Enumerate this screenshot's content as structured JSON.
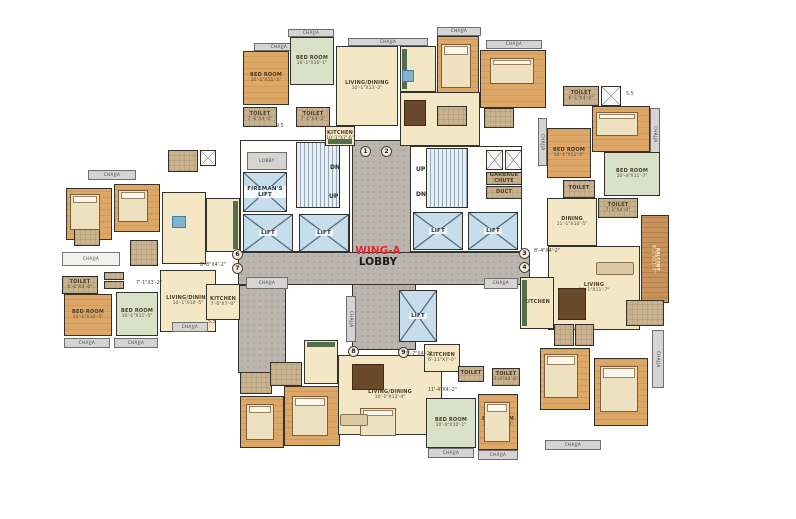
{
  "meta": {
    "width": 796,
    "height": 519,
    "background": "#ffffff",
    "description_labels": {
      "lift": "LIFT",
      "chajja": "CHAJJA"
    }
  },
  "title": {
    "wing": "WING-A",
    "lobby": "LOBBY",
    "wing_color": "#e8262d",
    "lobby_color": "#1a1a1a"
  },
  "palette": {
    "wall": "#33312c",
    "wood_floor": "#d4a05c",
    "green_floor": "#d9e2c8",
    "cream_floor": "#f3e7c6",
    "toilet_floor": "#c9b28d",
    "lift": "#c6ddec",
    "corridor": "#bab6ad",
    "balcony": "#c8935b",
    "accent_red": "#e8262d"
  },
  "rooms": [
    {
      "name": "lobby-corridor-vertical",
      "f": "corridor",
      "x": 352,
      "y": 140,
      "w": 64,
      "h": 210
    },
    {
      "name": "lobby-corridor-horizontal",
      "f": "corridor",
      "x": 238,
      "y": 252,
      "w": 292,
      "h": 33
    },
    {
      "name": "lobby-corridor-branch",
      "f": "corridor",
      "x": 238,
      "y": 285,
      "w": 48,
      "h": 88
    },
    {
      "name": "stair-hall-left",
      "f": "white",
      "x": 240,
      "y": 140,
      "w": 110,
      "h": 112
    },
    {
      "name": "stair-hall-right",
      "f": "white",
      "x": 410,
      "y": 146,
      "w": 112,
      "h": 106
    },
    {
      "name": "lobby-box",
      "f": "gray",
      "label": "LOBBY",
      "x": 247,
      "y": 152,
      "w": 40,
      "h": 18
    },
    {
      "name": "firemans-lift",
      "f": "lift",
      "label": "FIREMAN'S LIFT",
      "x": 243,
      "y": 172,
      "w": 44,
      "h": 40
    },
    {
      "name": "staircase-left",
      "f": "stairs",
      "x": 296,
      "y": 142,
      "w": 44,
      "h": 66
    },
    {
      "name": "lift-1",
      "f": "lift",
      "label": "LIFT",
      "x": 243,
      "y": 214,
      "w": 50,
      "h": 38
    },
    {
      "name": "lift-2",
      "f": "lift",
      "label": "LIFT",
      "x": 299,
      "y": 214,
      "w": 50,
      "h": 38
    },
    {
      "name": "staircase-right",
      "f": "stairs",
      "x": 426,
      "y": 148,
      "w": 42,
      "h": 60
    },
    {
      "name": "duct-box",
      "f": "xbox",
      "x": 486,
      "y": 150,
      "w": 17,
      "h": 20
    },
    {
      "name": "duct-box",
      "f": "xbox",
      "x": 505,
      "y": 150,
      "w": 17,
      "h": 20
    },
    {
      "name": "garbage-chute",
      "f": "tan",
      "label": "GARBAGE CHUTE",
      "x": 486,
      "y": 172,
      "w": 36,
      "h": 13
    },
    {
      "name": "duct",
      "f": "tan",
      "label": "DUCT",
      "x": 486,
      "y": 186,
      "w": 36,
      "h": 13
    },
    {
      "name": "lift-3",
      "f": "lift",
      "label": "LIFT",
      "x": 413,
      "y": 212,
      "w": 50,
      "h": 38
    },
    {
      "name": "lift-4",
      "f": "lift",
      "label": "LIFT",
      "x": 468,
      "y": 212,
      "w": 50,
      "h": 38
    },
    {
      "name": "lift-5",
      "f": "lift",
      "label": "LIFT",
      "x": 399,
      "y": 290,
      "w": 38,
      "h": 52
    },
    {
      "name": "chajja",
      "f": "gray",
      "label": "CHAJJA",
      "v": 1,
      "x": 346,
      "y": 296,
      "w": 10,
      "h": 46
    },
    {
      "name": "chajja",
      "f": "gray",
      "label": "CHAJJA",
      "x": 288,
      "y": 29,
      "w": 46,
      "h": 8
    },
    {
      "name": "chajja",
      "f": "gray",
      "label": "CHAJJA",
      "x": 254,
      "y": 43,
      "w": 50,
      "h": 8
    },
    {
      "name": "chajja",
      "f": "gray",
      "label": "CHAJJA",
      "x": 348,
      "y": 38,
      "w": 80,
      "h": 8
    },
    {
      "name": "bedroom",
      "f": "wood",
      "label": "BED ROOM",
      "dims": "10'-1\"X11'-5\"",
      "x": 243,
      "y": 51,
      "w": 46,
      "h": 54
    },
    {
      "name": "bedroom",
      "f": "green",
      "label": "BED ROOM",
      "dims": "10'-1\"X10'-1\"",
      "x": 290,
      "y": 37,
      "w": 44,
      "h": 48
    },
    {
      "name": "living-dining",
      "f": "cream",
      "label": "LIVING/DINING",
      "dims": "10'-1\"X13'-2\"",
      "x": 336,
      "y": 46,
      "w": 62,
      "h": 80
    },
    {
      "name": "toilet",
      "f": "tan",
      "label": "TOILET",
      "dims": "7'-6\"X4'-0\"",
      "x": 243,
      "y": 107,
      "w": 34,
      "h": 20
    },
    {
      "name": "toilet",
      "f": "tan",
      "label": "TOILET",
      "dims": "7'-1\"X4'-2\"",
      "x": 296,
      "y": 107,
      "w": 34,
      "h": 20
    },
    {
      "name": "kitchen",
      "f": "cream",
      "label": "KITCHEN",
      "dims": "10'-1\"X7'-6\"",
      "x": 325,
      "y": 126,
      "w": 30,
      "h": 20,
      "deco": "cb"
    },
    {
      "name": "duct-box",
      "f": "xbox",
      "x": 200,
      "y": 150,
      "w": 16,
      "h": 16
    },
    {
      "name": "entrance-lobby",
      "f": "tan",
      "x": 168,
      "y": 150,
      "w": 30,
      "h": 22
    },
    {
      "name": "chajja",
      "f": "gray",
      "label": "CHAJJA",
      "x": 437,
      "y": 27,
      "w": 44,
      "h": 9
    },
    {
      "name": "chajja",
      "f": "gray",
      "label": "CHAJJA",
      "x": 486,
      "y": 40,
      "w": 56,
      "h": 9
    },
    {
      "name": "kitchen",
      "f": "cream",
      "x": 400,
      "y": 46,
      "w": 36,
      "h": 46,
      "deco": "cl"
    },
    {
      "name": "bedroom",
      "f": "wood",
      "x": 437,
      "y": 36,
      "w": 42,
      "h": 70
    },
    {
      "name": "bedroom",
      "f": "wood",
      "x": 480,
      "y": 50,
      "w": 66,
      "h": 58
    },
    {
      "name": "living-dining",
      "f": "cream",
      "x": 400,
      "y": 92,
      "w": 80,
      "h": 54
    },
    {
      "name": "toilet",
      "f": "tan",
      "x": 437,
      "y": 106,
      "w": 30,
      "h": 20
    },
    {
      "name": "toilet",
      "f": "tan",
      "x": 484,
      "y": 108,
      "w": 30,
      "h": 20
    },
    {
      "name": "toilet",
      "f": "tan",
      "label": "TOILET",
      "dims": "6'-1\"X4'-0\"",
      "x": 563,
      "y": 86,
      "w": 36,
      "h": 20
    },
    {
      "name": "duct-box",
      "f": "xbox",
      "x": 601,
      "y": 86,
      "w": 20,
      "h": 20
    },
    {
      "name": "bedroom",
      "f": "wood",
      "label": "BED ROOM",
      "dims": "10'-0\"X11'-1\"",
      "x": 592,
      "y": 106,
      "w": 58,
      "h": 46
    },
    {
      "name": "chajja",
      "f": "gray",
      "label": "CHAJJA",
      "v": 1,
      "x": 650,
      "y": 108,
      "w": 10,
      "h": 52
    },
    {
      "name": "chajja",
      "f": "gray",
      "label": "CHAJJA",
      "v": 1,
      "x": 538,
      "y": 118,
      "w": 9,
      "h": 48
    },
    {
      "name": "bedroom",
      "f": "wood",
      "label": "BED ROOM",
      "dims": "10'-1\"X11'-5\"",
      "x": 547,
      "y": 128,
      "w": 44,
      "h": 50
    },
    {
      "name": "bedroom",
      "f": "green",
      "label": "BED ROOM",
      "dims": "10'-4\"X11'-7\"",
      "x": 604,
      "y": 152,
      "w": 56,
      "h": 44
    },
    {
      "name": "toilet",
      "f": "tan",
      "label": "TOILET",
      "x": 563,
      "y": 180,
      "w": 32,
      "h": 18
    },
    {
      "name": "toilet",
      "f": "tan",
      "label": "TOILET",
      "dims": "7'-1\"X4'-0\"",
      "x": 598,
      "y": 198,
      "w": 40,
      "h": 20
    },
    {
      "name": "dining",
      "f": "cream",
      "label": "DINING",
      "dims": "11'-1\"X10'-5\"",
      "x": 547,
      "y": 198,
      "w": 50,
      "h": 48
    },
    {
      "name": "living",
      "f": "cream",
      "label": "LIVING",
      "dims": "10'-1\"X11'-7\"",
      "x": 548,
      "y": 246,
      "w": 92,
      "h": 84
    },
    {
      "name": "kitchen",
      "f": "cream",
      "label": "KITCHEN",
      "x": 520,
      "y": 277,
      "w": 34,
      "h": 52,
      "deco": "cl"
    },
    {
      "name": "balcony",
      "f": "balcony",
      "label": "BALCONY",
      "dims": "8'-1\"X11'-7\"",
      "v": 1,
      "x": 641,
      "y": 215,
      "w": 28,
      "h": 88
    },
    {
      "name": "toilet",
      "f": "tan",
      "x": 554,
      "y": 324,
      "w": 20,
      "h": 22
    },
    {
      "name": "toilet",
      "f": "tan",
      "x": 575,
      "y": 324,
      "w": 19,
      "h": 22
    },
    {
      "name": "bedroom",
      "f": "wood",
      "x": 540,
      "y": 348,
      "w": 50,
      "h": 62
    },
    {
      "name": "bedroom",
      "f": "wood",
      "x": 594,
      "y": 358,
      "w": 54,
      "h": 68
    },
    {
      "name": "dress",
      "f": "tan",
      "x": 626,
      "y": 300,
      "w": 38,
      "h": 26
    },
    {
      "name": "chajja",
      "f": "gray",
      "label": "CHAJJA",
      "v": 1,
      "x": 652,
      "y": 330,
      "w": 12,
      "h": 58
    },
    {
      "name": "chajja",
      "f": "gray",
      "label": "CHAJJA",
      "x": 545,
      "y": 440,
      "w": 56,
      "h": 10
    },
    {
      "name": "toilet",
      "f": "tan",
      "x": 240,
      "y": 372,
      "w": 32,
      "h": 22
    },
    {
      "name": "bedroom",
      "f": "wood",
      "x": 240,
      "y": 396,
      "w": 44,
      "h": 52
    },
    {
      "name": "kitchen",
      "f": "cream",
      "x": 304,
      "y": 340,
      "w": 34,
      "h": 44,
      "deco": "ct"
    },
    {
      "name": "bath",
      "f": "tan",
      "x": 270,
      "y": 362,
      "w": 32,
      "h": 24
    },
    {
      "name": "bedroom",
      "f": "wood",
      "x": 284,
      "y": 386,
      "w": 56,
      "h": 60
    },
    {
      "name": "living-dining",
      "f": "cream",
      "label": "LIVING/DINING",
      "dims": "10'-1\"X13'-4\"",
      "x": 338,
      "y": 355,
      "w": 104,
      "h": 80
    },
    {
      "name": "kitchen",
      "f": "cream",
      "label": "KITCHEN",
      "dims": "6'-11\"X7'-0\"",
      "x": 424,
      "y": 344,
      "w": 36,
      "h": 28
    },
    {
      "name": "toilet",
      "f": "tan",
      "label": "TOILET",
      "x": 458,
      "y": 366,
      "w": 26,
      "h": 16
    },
    {
      "name": "toilet",
      "f": "tan",
      "label": "TOILET",
      "dims": "7'-0\"X4'-0\"",
      "x": 492,
      "y": 368,
      "w": 28,
      "h": 18
    },
    {
      "name": "bedroom",
      "f": "green",
      "label": "BED ROOM",
      "dims": "10'-4\"X10'-1\"",
      "x": 426,
      "y": 398,
      "w": 50,
      "h": 50
    },
    {
      "name": "bedroom",
      "f": "wood",
      "label": "BED ROOM",
      "dims": "10'-0\"X11'-0\"",
      "x": 478,
      "y": 394,
      "w": 40,
      "h": 56
    },
    {
      "name": "chajja",
      "f": "gray",
      "label": "CHAJJA",
      "x": 428,
      "y": 448,
      "w": 46,
      "h": 10
    },
    {
      "name": "chajja",
      "f": "gray",
      "label": "CHAJJA",
      "x": 478,
      "y": 450,
      "w": 40,
      "h": 10
    },
    {
      "name": "chajja",
      "f": "gray",
      "label": "CHAJJA",
      "x": 484,
      "y": 278,
      "w": 34,
      "h": 11
    },
    {
      "name": "toilet",
      "f": "tan",
      "label": "TOILET",
      "dims": "6'-0\"X4'-0\"",
      "x": 62,
      "y": 276,
      "w": 36,
      "h": 18
    },
    {
      "name": "wardrobe",
      "f": "tan",
      "x": 104,
      "y": 272,
      "w": 20,
      "h": 8
    },
    {
      "name": "wardrobe",
      "f": "tan",
      "x": 104,
      "y": 281,
      "w": 20,
      "h": 8
    },
    {
      "name": "bedroom",
      "f": "wood",
      "label": "BED ROOM",
      "dims": "10'-1\"X10'-5\"",
      "x": 64,
      "y": 294,
      "w": 48,
      "h": 42
    },
    {
      "name": "bedroom",
      "f": "green",
      "label": "BED ROOM",
      "dims": "10'-1\"X11'-5\"",
      "x": 116,
      "y": 292,
      "w": 42,
      "h": 44
    },
    {
      "name": "living-dining",
      "f": "cream",
      "label": "LIVING/DINING",
      "dims": "10'-1\"X10'-5\"",
      "x": 160,
      "y": 270,
      "w": 56,
      "h": 62
    },
    {
      "name": "kitchen",
      "f": "cream",
      "label": "KITCHEN",
      "dims": "7'-6\"X7'-0\"",
      "x": 206,
      "y": 284,
      "w": 34,
      "h": 36
    },
    {
      "name": "chajja",
      "f": "gray",
      "label": "CHAJJA",
      "x": 64,
      "y": 338,
      "w": 46,
      "h": 10
    },
    {
      "name": "chajja",
      "f": "gray",
      "label": "CHAJJA",
      "x": 114,
      "y": 338,
      "w": 44,
      "h": 10
    },
    {
      "name": "chajja",
      "f": "gray",
      "label": "CHAJJA",
      "x": 246,
      "y": 277,
      "w": 42,
      "h": 12
    },
    {
      "name": "chajja",
      "f": "gray",
      "label": "CHAJJA",
      "x": 172,
      "y": 322,
      "w": 36,
      "h": 10
    },
    {
      "name": "chajja",
      "f": "gray",
      "label": "CHAJJA",
      "x": 88,
      "y": 170,
      "w": 48,
      "h": 10
    },
    {
      "name": "bedroom",
      "f": "wood",
      "x": 66,
      "y": 188,
      "w": 46,
      "h": 52
    },
    {
      "name": "bedroom",
      "f": "wood",
      "x": 114,
      "y": 184,
      "w": 46,
      "h": 48
    },
    {
      "name": "toilet",
      "f": "tan",
      "x": 74,
      "y": 228,
      "w": 26,
      "h": 18
    },
    {
      "name": "toilet",
      "f": "tan",
      "x": 130,
      "y": 240,
      "w": 28,
      "h": 26
    },
    {
      "name": "living",
      "f": "cream",
      "x": 162,
      "y": 192,
      "w": 44,
      "h": 72
    },
    {
      "name": "kitchen",
      "f": "cream",
      "x": 206,
      "y": 198,
      "w": 34,
      "h": 54,
      "deco": "cr"
    },
    {
      "name": "chajja",
      "f": "whitebox",
      "label": "CHAJJA",
      "x": 62,
      "y": 252,
      "w": 58,
      "h": 14
    }
  ],
  "furniture": [
    {
      "t": "bed",
      "x": 441,
      "y": 44,
      "w": 30,
      "h": 44
    },
    {
      "t": "bed",
      "x": 490,
      "y": 58,
      "w": 44,
      "h": 26
    },
    {
      "t": "bed",
      "x": 596,
      "y": 112,
      "w": 42,
      "h": 24
    },
    {
      "t": "bed",
      "x": 70,
      "y": 194,
      "w": 30,
      "h": 36
    },
    {
      "t": "bed",
      "x": 118,
      "y": 190,
      "w": 30,
      "h": 32
    },
    {
      "t": "bed",
      "x": 544,
      "y": 354,
      "w": 34,
      "h": 44
    },
    {
      "t": "bed",
      "x": 600,
      "y": 366,
      "w": 38,
      "h": 46
    },
    {
      "t": "bed",
      "x": 292,
      "y": 396,
      "w": 36,
      "h": 40
    },
    {
      "t": "bed",
      "x": 246,
      "y": 404,
      "w": 28,
      "h": 36
    },
    {
      "t": "bed",
      "x": 360,
      "y": 408,
      "w": 36,
      "h": 28
    },
    {
      "t": "bed",
      "x": 484,
      "y": 402,
      "w": 26,
      "h": 40
    },
    {
      "t": "table",
      "x": 404,
      "y": 100,
      "w": 22,
      "h": 26
    },
    {
      "t": "table",
      "x": 352,
      "y": 364,
      "w": 32,
      "h": 26
    },
    {
      "t": "table",
      "x": 558,
      "y": 288,
      "w": 28,
      "h": 32
    },
    {
      "t": "btable",
      "x": 172,
      "y": 216,
      "w": 14,
      "h": 12
    },
    {
      "t": "btable",
      "x": 402,
      "y": 70,
      "w": 12,
      "h": 12
    },
    {
      "t": "sofa",
      "x": 340,
      "y": 414,
      "w": 28,
      "h": 12
    },
    {
      "t": "sofa",
      "x": 596,
      "y": 262,
      "w": 38,
      "h": 13
    }
  ],
  "markers": [
    {
      "n": "1",
      "x": 360,
      "y": 146
    },
    {
      "n": "2",
      "x": 381,
      "y": 146
    },
    {
      "n": "3",
      "x": 519,
      "y": 248
    },
    {
      "n": "4",
      "x": 519,
      "y": 262
    },
    {
      "n": "6",
      "x": 232,
      "y": 249
    },
    {
      "n": "7",
      "x": 232,
      "y": 263
    },
    {
      "n": "8",
      "x": 348,
      "y": 346
    },
    {
      "n": "9",
      "x": 398,
      "y": 347
    }
  ],
  "labels": [
    {
      "t": "DN",
      "x": 330,
      "y": 164,
      "b": 1
    },
    {
      "t": "UP",
      "x": 329,
      "y": 193,
      "b": 1
    },
    {
      "t": "UP",
      "x": 416,
      "y": 166,
      "b": 1
    },
    {
      "t": "DN",
      "x": 416,
      "y": 191,
      "b": 1
    },
    {
      "t": "8'-8\"X4'-2\"",
      "x": 200,
      "y": 263
    },
    {
      "t": "8'-4\"X4'-2\"",
      "x": 534,
      "y": 249
    },
    {
      "t": "5'-7\"X4'-2\"",
      "x": 406,
      "y": 352
    },
    {
      "t": "11'-4\"X4'-2\"",
      "x": 428,
      "y": 388
    },
    {
      "t": "7'-1\"X3'-2\"",
      "x": 136,
      "y": 281
    },
    {
      "t": "5.5",
      "x": 626,
      "y": 92
    },
    {
      "t": "5.5",
      "x": 208,
      "y": 320
    },
    {
      "t": "9.5",
      "x": 276,
      "y": 124
    }
  ]
}
